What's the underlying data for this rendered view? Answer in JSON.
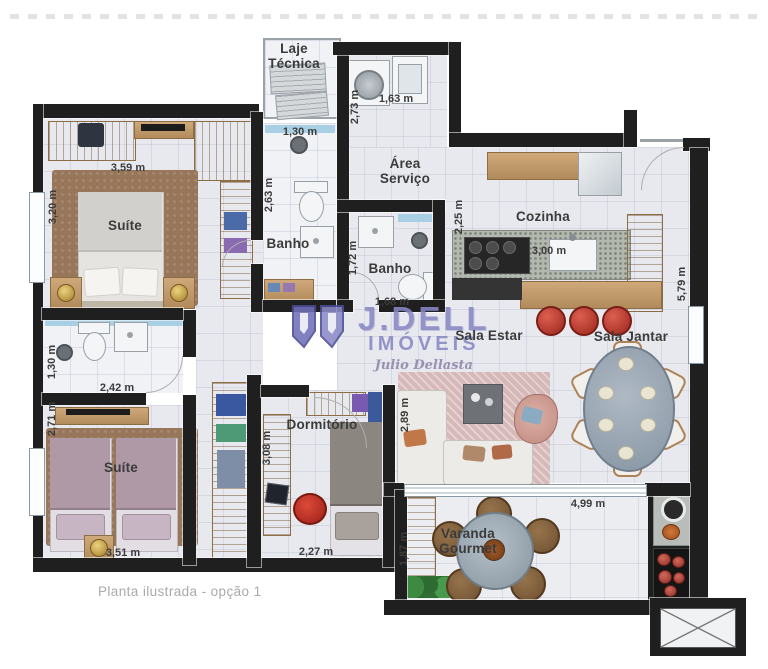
{
  "caption": "Planta ilustrada - opção 1",
  "watermark": {
    "brand": "J.DELL",
    "subtitle": "IMÓVEIS",
    "signature": "Julio Dellasta",
    "color": "#8888c6"
  },
  "colors": {
    "wall": "#1f1f1f",
    "floor": "#e8e9ee",
    "wood": "#c49a68",
    "stool_red": "#b0342a",
    "watermark_purple": "#8888c6",
    "shower_glass_blue": "#a9cfe4"
  },
  "room_labels": [
    {
      "id": "laje-tecnica",
      "text": "Laje Técnica",
      "x": 294,
      "y": 42,
      "w": 56
    },
    {
      "id": "area-servico",
      "text": "Área Serviço",
      "x": 405,
      "y": 157,
      "w": 60
    },
    {
      "id": "cozinha",
      "text": "Cozinha",
      "x": 543,
      "y": 210
    },
    {
      "id": "banho-suite",
      "text": "Banho",
      "x": 288,
      "y": 237
    },
    {
      "id": "banho-social",
      "text": "Banho",
      "x": 390,
      "y": 262
    },
    {
      "id": "suite-master",
      "text": "Suíte",
      "x": 125,
      "y": 219
    },
    {
      "id": "suite-second",
      "text": "Suíte",
      "x": 121,
      "y": 461
    },
    {
      "id": "dormitorio",
      "text": "Dormitório",
      "x": 322,
      "y": 418
    },
    {
      "id": "sala-estar",
      "text": "Sala Estar",
      "x": 489,
      "y": 329
    },
    {
      "id": "sala-jantar",
      "text": "Sala Jantar",
      "x": 631,
      "y": 330
    },
    {
      "id": "varanda-gourmet",
      "text": "Varanda Gourmet",
      "x": 468,
      "y": 527,
      "w": 94
    }
  ],
  "measurements": [
    {
      "text": "3,59 m",
      "x": 128,
      "y": 168,
      "vertical": false
    },
    {
      "text": "3,20 m",
      "x": 53,
      "y": 207,
      "vertical": true
    },
    {
      "text": "1,30 m",
      "x": 300,
      "y": 132,
      "vertical": false
    },
    {
      "text": "2,63 m",
      "x": 269,
      "y": 195,
      "vertical": true
    },
    {
      "text": "1,63 m",
      "x": 396,
      "y": 99,
      "vertical": false
    },
    {
      "text": "2,73 m",
      "x": 355,
      "y": 107,
      "vertical": true
    },
    {
      "text": "2,25 m",
      "x": 459,
      "y": 217,
      "vertical": true
    },
    {
      "text": "3,00 m",
      "x": 549,
      "y": 251,
      "vertical": false
    },
    {
      "text": "5,79 m",
      "x": 682,
      "y": 284,
      "vertical": true
    },
    {
      "text": "1,72 m",
      "x": 353,
      "y": 258,
      "vertical": true
    },
    {
      "text": "1,68 m",
      "x": 392,
      "y": 302,
      "vertical": false
    },
    {
      "text": "1,30 m",
      "x": 52,
      "y": 362,
      "vertical": true
    },
    {
      "text": "2,42 m",
      "x": 117,
      "y": 388,
      "vertical": false
    },
    {
      "text": "2,71 m",
      "x": 52,
      "y": 419,
      "vertical": true
    },
    {
      "text": "3,51 m",
      "x": 123,
      "y": 553,
      "vertical": false
    },
    {
      "text": "3,08 m",
      "x": 267,
      "y": 448,
      "vertical": true
    },
    {
      "text": "2,27 m",
      "x": 316,
      "y": 552,
      "vertical": false
    },
    {
      "text": "2,89 m",
      "x": 405,
      "y": 415,
      "vertical": true
    },
    {
      "text": "4,99 m",
      "x": 588,
      "y": 504,
      "vertical": false
    },
    {
      "text": "1,87 m",
      "x": 404,
      "y": 549,
      "vertical": true
    }
  ]
}
